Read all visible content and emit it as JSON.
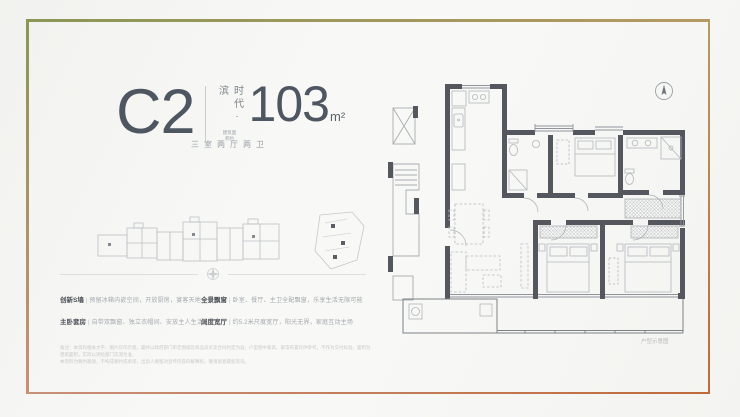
{
  "page": {
    "background": "#f8f8f6"
  },
  "frame": {
    "top_left": "#8b9655",
    "top_right": "#b59a63",
    "bottom_right": "#bf6a3c",
    "bottom_left": "#c98f78"
  },
  "header": {
    "unit_code": "C2",
    "brand_vertical": "时代·滨",
    "area_note": "建筑面积约",
    "area_value": "103",
    "area_unit": "m²",
    "tagline": "三室两厅两卫"
  },
  "feature_separator": "|",
  "features": [
    {
      "label": "创新S墙",
      "desc": "预留冰箱内嵌空间，开放厨房，宴客天地更舒适"
    },
    {
      "label": "全景飘窗",
      "desc": "卧室、餐厅、主卫全配飘窗，乐享生活无限可能"
    },
    {
      "label": "主卧套房",
      "desc": "自带双飘窗、独立衣帽间、安放主人生活品味"
    },
    {
      "label": "阔度宽厅",
      "desc": "约5.2米尺度宽厅，阳光无界，家庭互动主场"
    }
  ],
  "disclaimer": {
    "line1": "备注：本资料相关文字、图片仅作示意，最终以政府部门审定图纸及商品房买卖合同约定为准；户型图中家具、家电布置仅供参考，不作为交付标准；面积为建筑面积，实际以测绘部门实测为准。",
    "line2": "本资料为要约邀请，不构成要约或承诺，出卖人保留对宣传内容的解释权，敬请留意最新资讯。"
  },
  "floor_plan": {
    "caption": "户型示意图",
    "wall_color": "#54575d"
  },
  "icons": {
    "compass": "north-compass",
    "ornament": "divider-ornament"
  }
}
